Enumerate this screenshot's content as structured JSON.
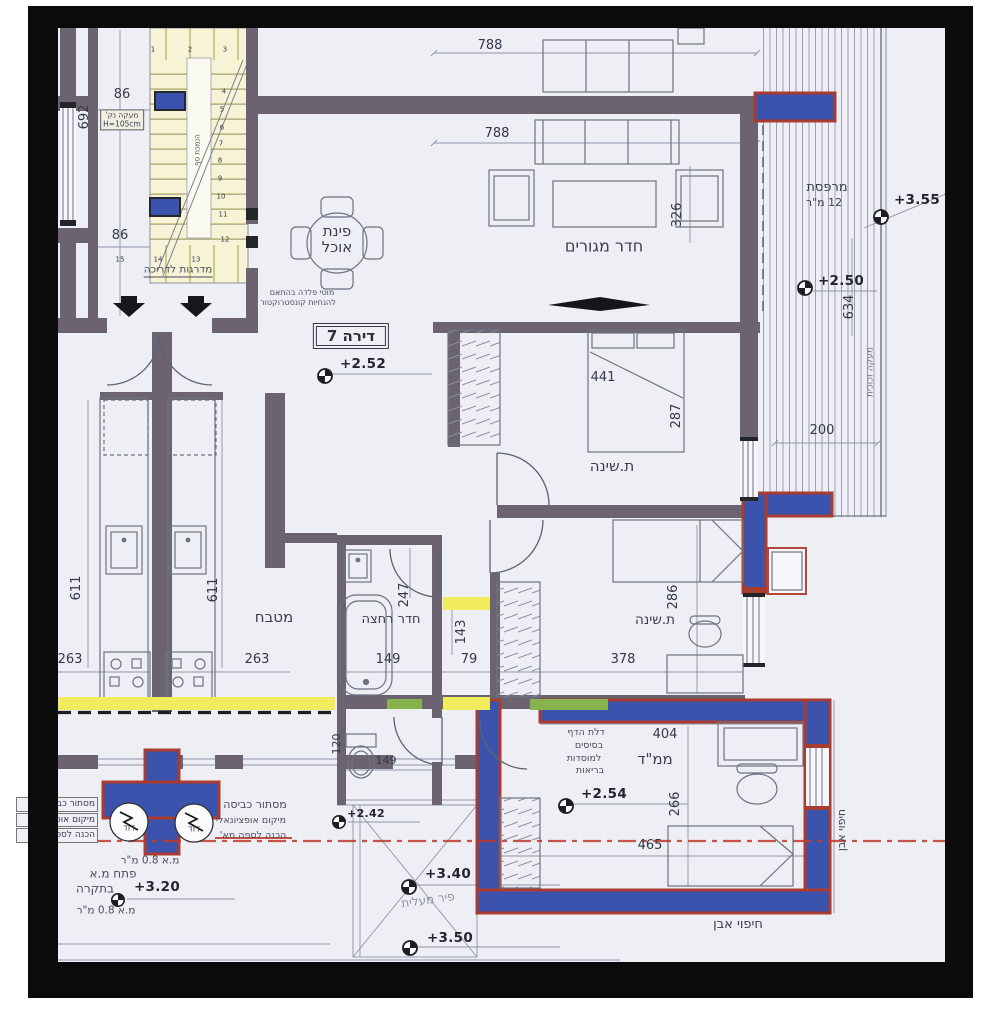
{
  "plan": {
    "apartment_label": "דירה 7",
    "rooms": {
      "dining_line1": "פינת",
      "dining_line2": "אוכל",
      "living": "חדר מגורים",
      "balcony": "מרפסת",
      "balcony_area": "12 מ\"ר",
      "bedroom1": "ת.שינה",
      "bedroom2": "ת.שינה",
      "bathroom": "חדר רחצה",
      "kitchen": "מטבח",
      "safe_room": "ממ\"ד",
      "elevator_shaft": "פיר מעלית"
    },
    "levels": {
      "dining": "+2.52",
      "balcony_top": "+3.55",
      "balcony": "+2.50",
      "safe_room": "+2.54",
      "corridor": "+2.42",
      "shaft": "+3.40",
      "shaft_low": "+3.50",
      "ceiling": "+3.20"
    },
    "dims": {
      "top_width": "788",
      "living_width": "788",
      "living_depth": "326",
      "stair_len": "692",
      "stair_w_top": "86",
      "stair_w_bot": "86",
      "bed1_w": "441",
      "bed1_d": "287",
      "balcony_w": "200",
      "balcony_len": "634",
      "kitchen_l": "611",
      "kitchen_r": "611",
      "kitchen_wl": "263",
      "kitchen_wr": "263",
      "bath_len": "247",
      "bath_w": "149",
      "hall_len": "143",
      "hall_w": "79",
      "bed2_w": "378",
      "bed2_d": "286",
      "mamad_w": "404",
      "mamad_d": "266",
      "mamad_len": "465",
      "wc_w": "149",
      "wc_len": "120"
    },
    "notes": {
      "stairs": "מדרגות לדריכה",
      "railing": "מעקה נק'",
      "railing_h": "H=105cm",
      "stair_side": "הנמכת סף",
      "steel1": "מוטי פלדה בהתאם",
      "steel2": "להנחיות קונסטרוקטור",
      "laundry": "מסתור כביסה",
      "laundry_opt": "מיקום אופציונאלי",
      "laundry_prep": "הכנה לספה מא'",
      "boiler": "דוד",
      "mamad1": "דלת הדף",
      "mamad2": "בסיסים",
      "mamad3": "למוסדות",
      "mamad4": "בריאות",
      "stone": "חיפוי אבן",
      "glass_rail": "מעקה זכוכית",
      "ceil1": "מ.א 0.8 מ\"ר",
      "ceil2": "פתח מ.א",
      "ceil3": "בתקרה",
      "ceil4": "מ.א 0.8 מ\"ר"
    },
    "stair_numbers": [
      "1",
      "2",
      "3",
      "4",
      "5",
      "6",
      "7",
      "8",
      "9",
      "10",
      "11",
      "12",
      "13",
      "14",
      "15"
    ]
  }
}
